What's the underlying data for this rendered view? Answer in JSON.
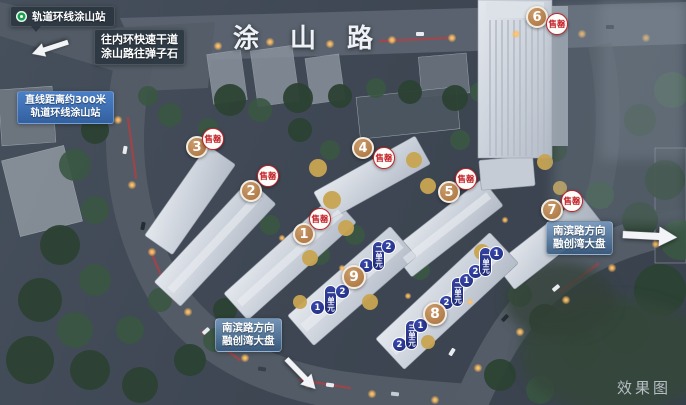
{
  "scene": {
    "road_name": "涂山路",
    "watermark": "效果图"
  },
  "callouts": {
    "station": {
      "text": "轨道环线涂山站",
      "icon": "metro-logo"
    },
    "expressway": {
      "line1": "往内环快速干道",
      "line2": "涂山路往弹子石"
    },
    "distance": {
      "line1": "直线距离约300米",
      "line2": "轨道环线涂山站"
    },
    "nanbin_right": {
      "line1": "南滨路方向",
      "line2": "融创湾大盘"
    },
    "nanbin_bottom": {
      "line1": "南滨路方向",
      "line2": "融创湾大盘"
    }
  },
  "markers": {
    "b1": {
      "no": "1",
      "status": "售罄"
    },
    "b2": {
      "no": "2",
      "status": "售罄"
    },
    "b3": {
      "no": "3",
      "status": "售罄"
    },
    "b4": {
      "no": "4",
      "status": "售罄"
    },
    "b5": {
      "no": "5",
      "status": "售罄"
    },
    "b6": {
      "no": "6",
      "status": "售罄"
    },
    "b7": {
      "no": "7",
      "status": "售罄"
    },
    "b8": {
      "no": "8"
    },
    "b9": {
      "no": "9"
    }
  },
  "unit_rows": {
    "b9": [
      "1",
      "一单元",
      "2",
      "1",
      "二单元",
      "2"
    ],
    "b8": [
      "2",
      "三单元",
      "1",
      "2",
      "二单元",
      "1",
      "2",
      "一单元",
      "1"
    ]
  },
  "colors": {
    "marker_tan": "#a8713d",
    "marker_navy": "#1d2a78",
    "sold_out_red": "#c4232a",
    "badge_blue": "#33619f",
    "station_green": "#17a14f"
  }
}
